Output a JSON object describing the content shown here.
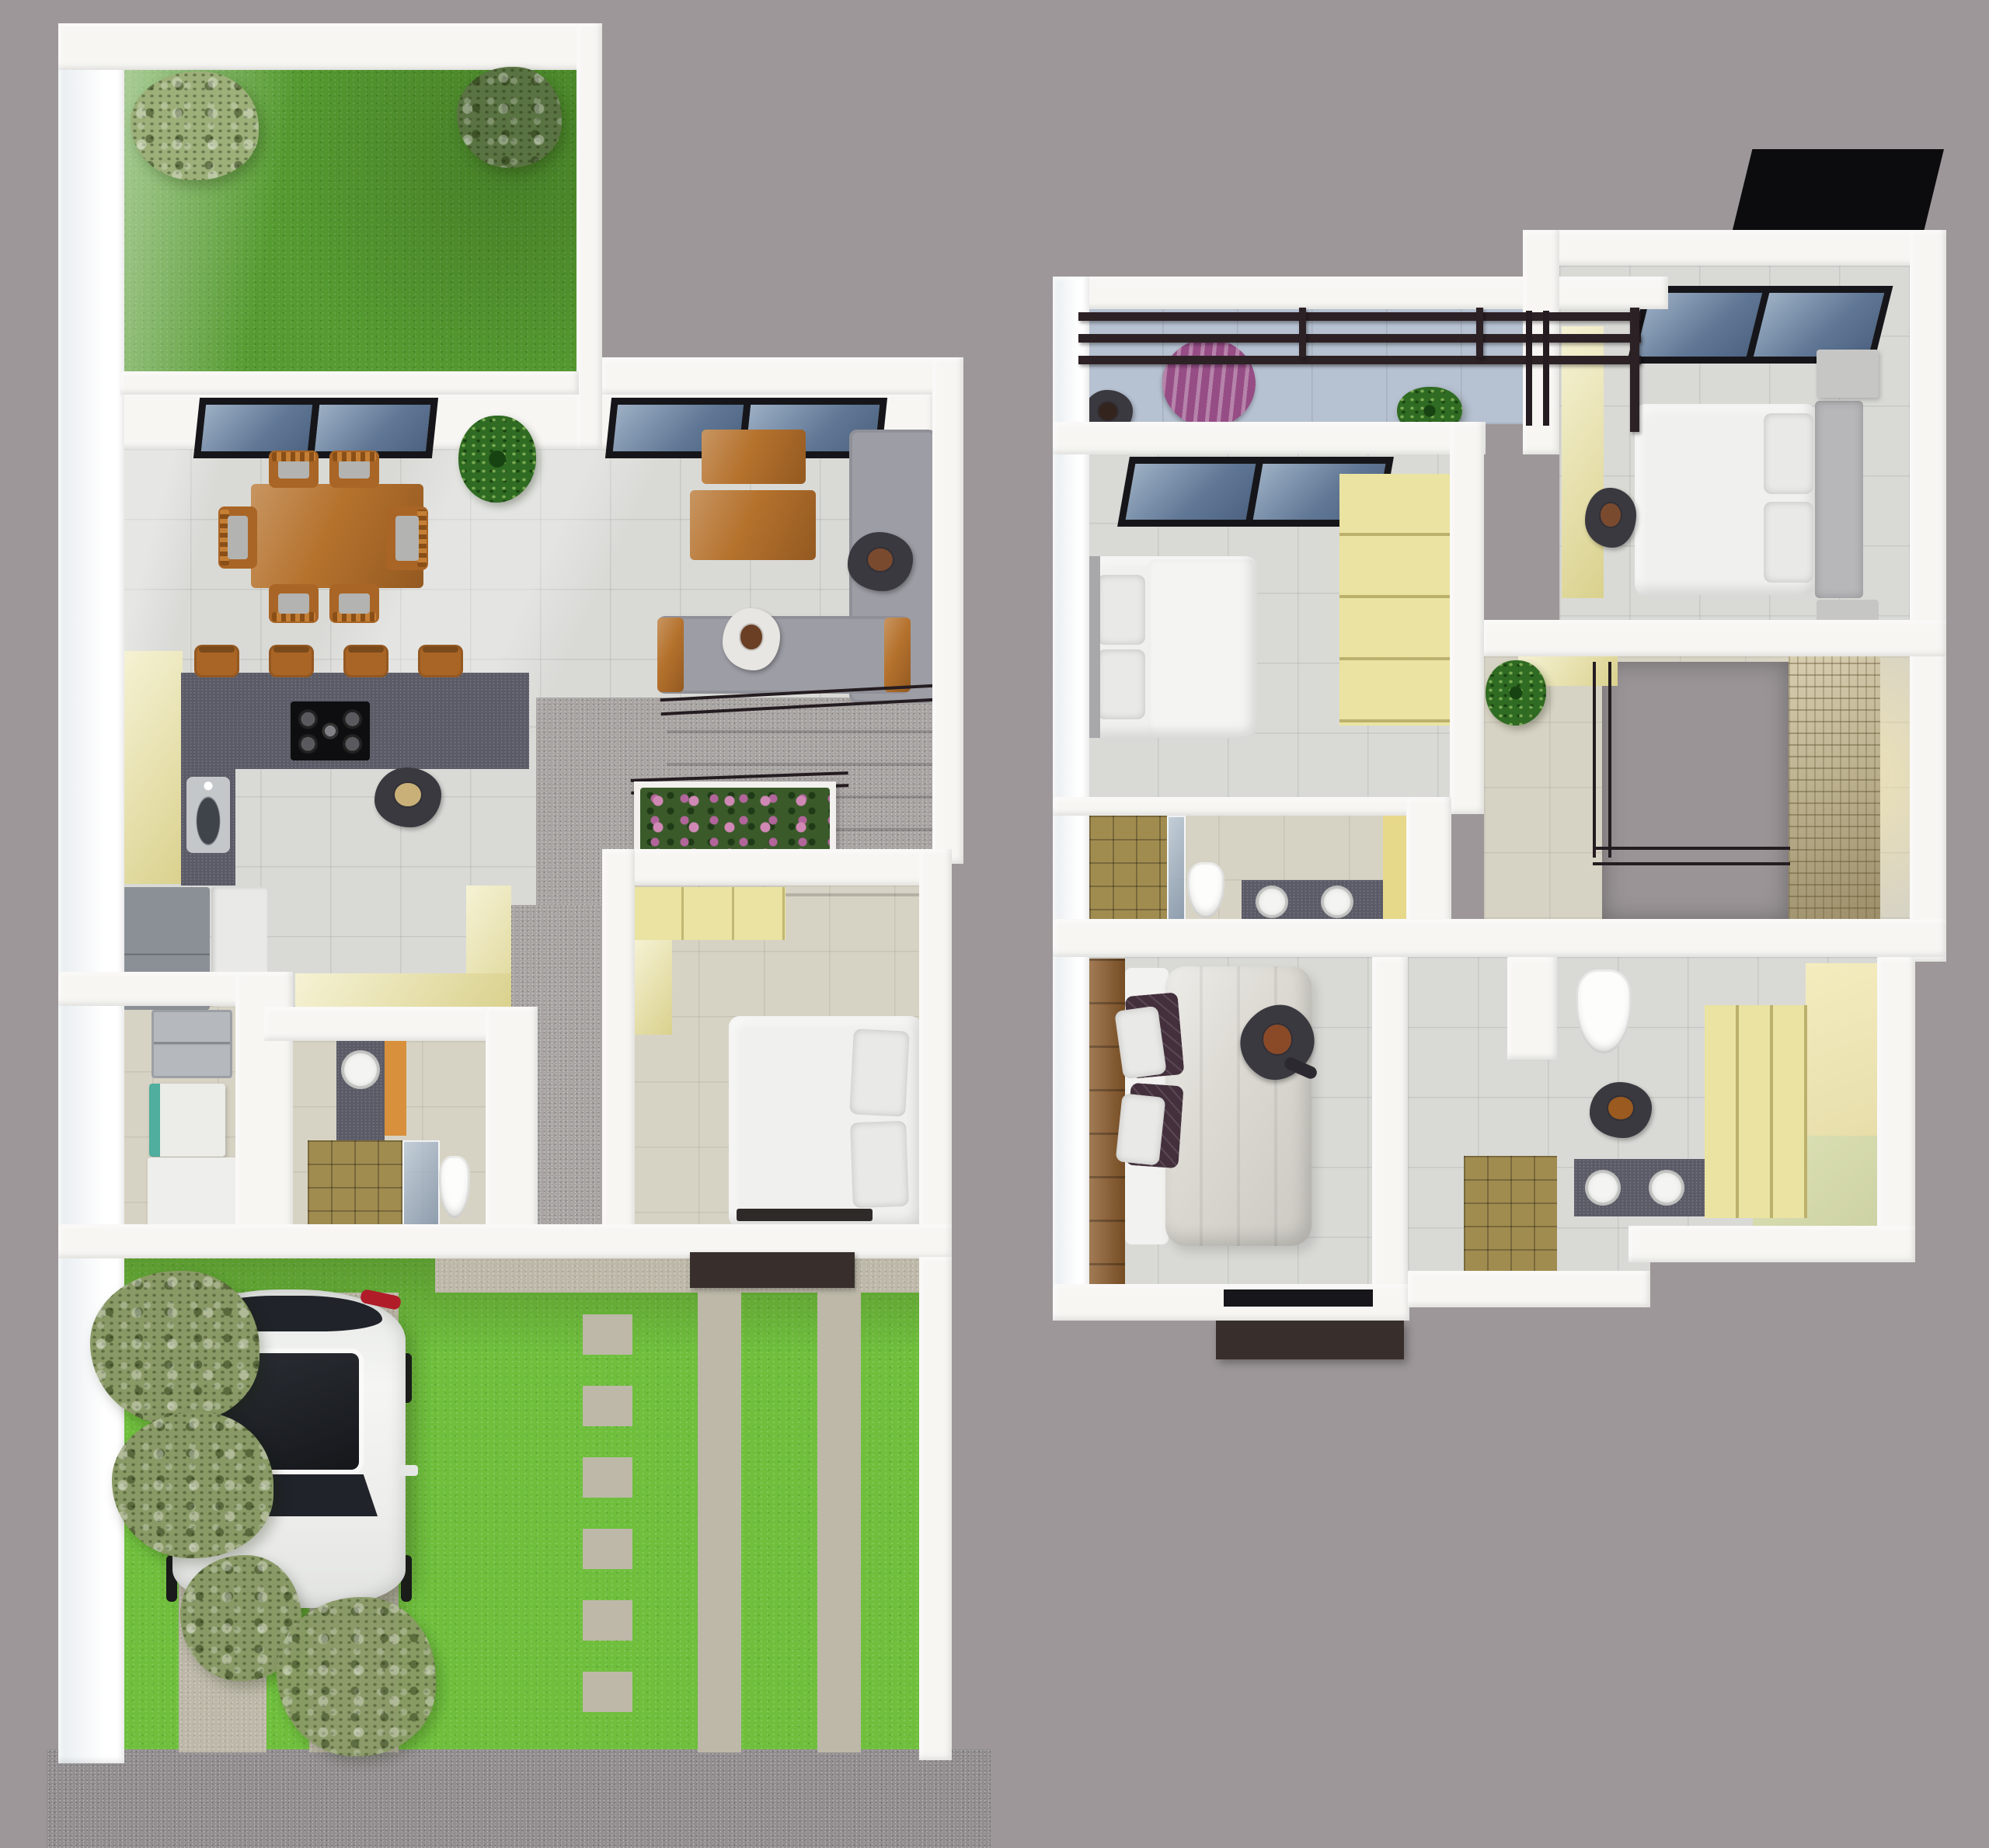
{
  "view": {
    "title": "3D rendered house floor plans, top-down view: ground floor (left) and upper floor (right)"
  },
  "palette": {
    "background": "#9d9799",
    "sidewalk": "#928e90",
    "wall": "#f7f6f3",
    "grassBack": "#569b31",
    "grassFront": "#6fbf3d",
    "concrete": "#bdb8a8",
    "tileLight": "#d9dad6",
    "tileBeige": "#d7d3c4",
    "paving": "#a8a4a2",
    "woodOrange": "#b5722d",
    "counterDark": "#5b5b67",
    "cabinetYellow": "#eae3a1",
    "applianceGray": "#8b9096",
    "sofaGray": "#9d9da5",
    "bedWhite": "#f0f0ee",
    "duvetGray": "#dcdad3",
    "pillowDark": "#43303c",
    "balconyFloor": "#b6c1d1",
    "purpleTable": "#964d86",
    "stoneWall": "#c6b98e",
    "showerTan": "#a18c50",
    "frameDark": "#16161a",
    "roofBlack": "#0c0c0e",
    "flowerPink": "#d088b5",
    "plantGreen": "#2f6b22",
    "treeOlive": "#8a9a66",
    "carWhite": "#ededeb",
    "carGlass": "#202329",
    "woodFloor": "#8a5a2a",
    "brownBox": "#382f2c",
    "voidGray": "#9a9496",
    "suitDark": "#3b3940",
    "headBrown": "#7a4a2e",
    "closetFloor": "#e9e0ae",
    "greenWall": "#cdd2a4",
    "yellowAccent": "#e6d98a",
    "headboardGray": "#b7b7b9",
    "tealAccent": "#4fae9d",
    "orangeCab": "#d8903c"
  },
  "ground_floor": {
    "name": "ground-floor-plan",
    "areas": [
      "backyard-garden",
      "living-dining-room",
      "kitchen",
      "stair-hall",
      "utility-room",
      "bathroom",
      "bedroom",
      "front-yard-driveway"
    ],
    "furniture": {
      "dining": "wooden dining table with six wooden chairs",
      "living": "L-shaped grey sofa set with wooden arm tables and wooden coffee table",
      "kitchen": "dark L-shaped counter with gas hob, four wooden bar stools, yellow cabinets, sink, fridge",
      "stair_hall": "descending grey stairs with dark railing and pink flower planter",
      "utility": "wall shelf, washing machine, storage cabinets",
      "bathroom": "round basin on dark counter, orange cabinet, tan-tiled shower, toilet",
      "bedroom": "double bed with pillows and yellow wardrobe",
      "yard": "white car on twin concrete tracks, trees, striped grass-and-paver forecourt, dark entry mat"
    },
    "people_count": 3
  },
  "upper_floor": {
    "name": "upper-floor-plan",
    "areas": [
      "balcony-terrace",
      "bedroom-front",
      "bedroom-left",
      "stair-void-hallway",
      "bathroom-shared",
      "master-bedroom",
      "master-bathroom-walk-in-closet"
    ],
    "furniture": {
      "balcony": "pergola beams, purple slatted round table, potted plant",
      "bedroom_front": "skylight, double bed with grey headboard, nightstands, yellow wardrobe strip, black roof slab outside",
      "bedroom_left": "skylight, single bed, tall yellow wardrobe",
      "hallway": "open stair void with dark railing, stacked-stone feature wall, plant, yellow shelf",
      "bathroom_shared": "tan shower, toilet, dark counter with two round basins",
      "master_bedroom": "large bed with fluffy duvet, dark and grey pillows, wooden headboard strip, window with planter box below",
      "master_bathroom": "toilet alcove, dark counter with two round basins, tan shower, yellow walk-in wardrobes"
    },
    "people_count": 4
  }
}
